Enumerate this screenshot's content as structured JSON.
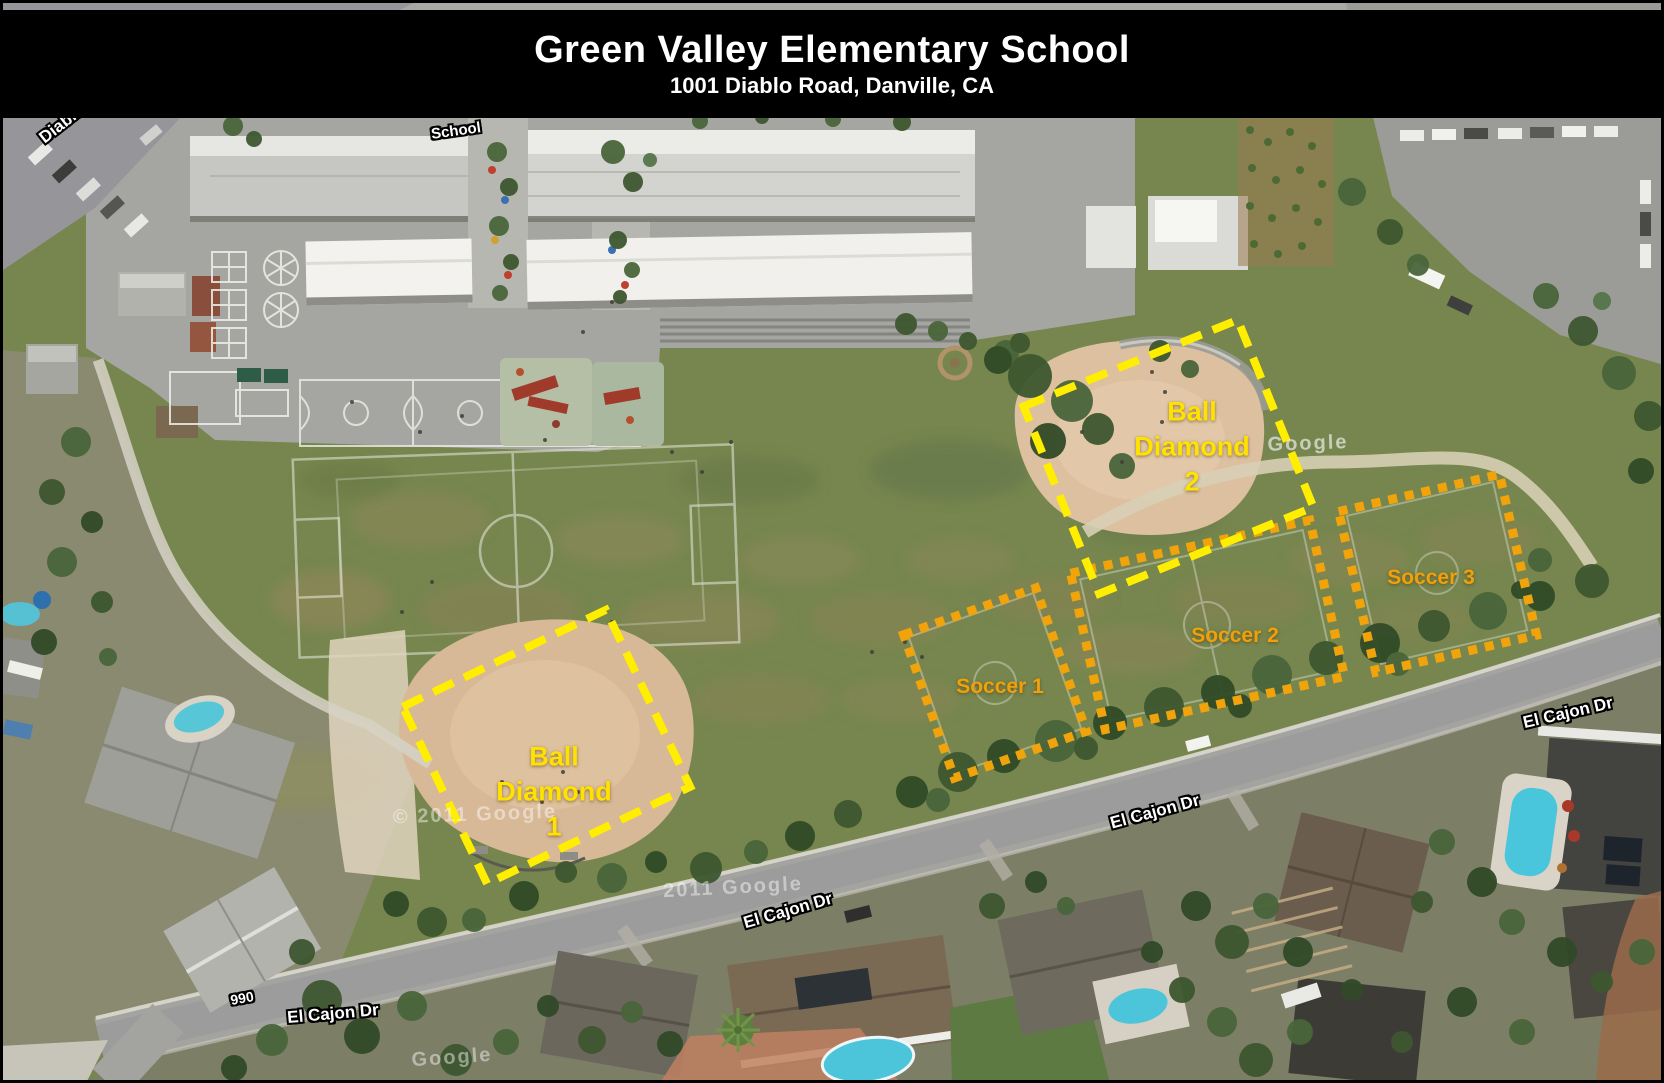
{
  "header": {
    "title": "Green Valley Elementary School",
    "subtitle": "1001 Diablo Road, Danville, CA"
  },
  "regions": {
    "ball_diamond_1": {
      "label": "Ball Diamond 1",
      "lines": [
        "Ball",
        "Diamond",
        "1"
      ],
      "outline": "yellow-dashed",
      "outline_color": "#ffee00",
      "label_color": "#ffe200"
    },
    "ball_diamond_2": {
      "label": "Ball Diamond 2",
      "lines": [
        "Ball",
        "Diamond",
        "2"
      ],
      "outline": "yellow-dashed",
      "outline_color": "#ffee00",
      "label_color": "#ffe200"
    },
    "soccer_1": {
      "label": "Soccer 1",
      "outline": "orange-dotted",
      "outline_color": "#f0a30a",
      "label_color": "#eea10c"
    },
    "soccer_2": {
      "label": "Soccer 2",
      "outline": "orange-dotted",
      "outline_color": "#f0a30a",
      "label_color": "#eea10c"
    },
    "soccer_3": {
      "label": "Soccer 3",
      "outline": "orange-dotted",
      "outline_color": "#f0a30a",
      "label_color": "#eea10c"
    }
  },
  "street_labels": {
    "diablo_road": {
      "text": "Diablo"
    },
    "school": {
      "text": "School"
    },
    "el_cajon_right": {
      "text": "El Cajon Dr"
    },
    "el_cajon_mid_right": {
      "text": "El Cajon Dr"
    },
    "el_cajon_mid": {
      "text": "El Cajon Dr"
    },
    "el_cajon_left": {
      "text": "El Cajon Dr"
    },
    "house_number_990": {
      "text": "990"
    }
  },
  "watermarks": {
    "near_diamond_1": {
      "text": "© 2011 Google"
    },
    "mid_bottom": {
      "text": "2011 Google"
    },
    "bottom_left": {
      "text": "Google"
    },
    "right_path": {
      "text": "Google"
    }
  }
}
